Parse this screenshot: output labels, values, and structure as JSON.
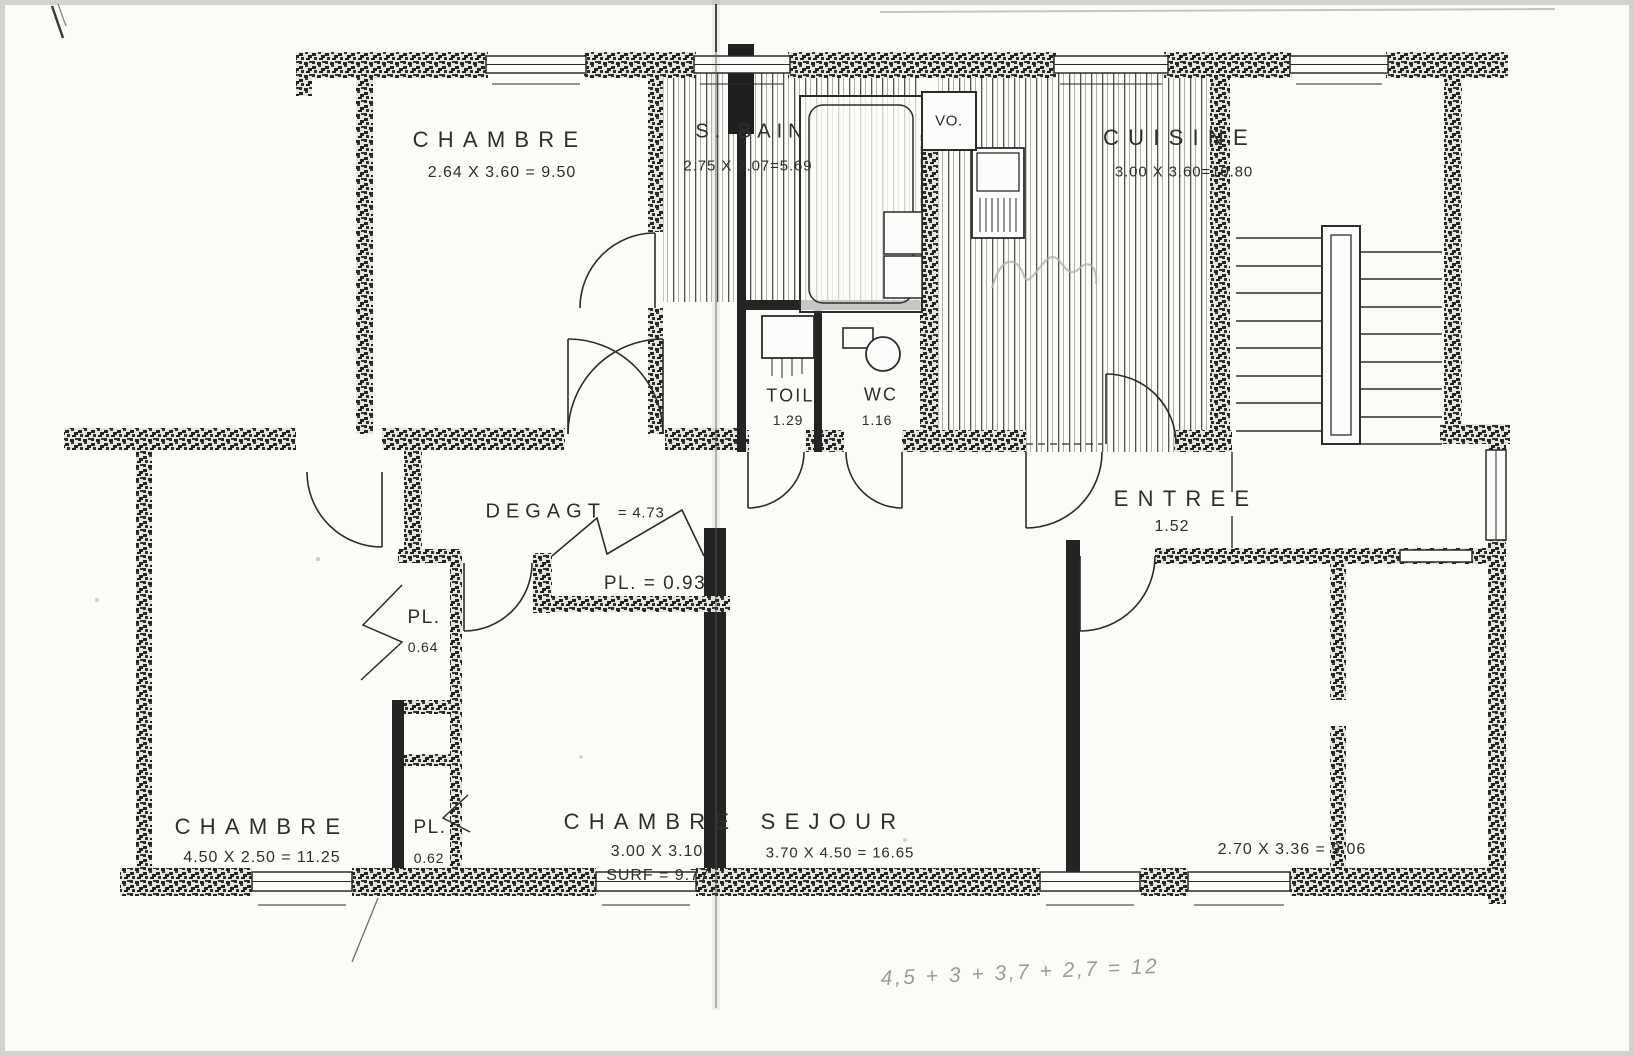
{
  "colors": {
    "ink": "#2b2b2b",
    "paper": "#fcfbf7",
    "pencil": "#9d9c98"
  },
  "rooms": {
    "chambre_top": {
      "label": "CHAMBRE",
      "dims": "2.64 X 3.60 = 9.50"
    },
    "salle_de_bain": {
      "label": "S. BAIN",
      "dims": "2.75 X 2.07=5.69"
    },
    "vide_ordures": {
      "label": "VO."
    },
    "cuisine": {
      "label": "CUISINE",
      "dims": "3.00 X 3.60=10.80"
    },
    "toilette": {
      "label": "TOIL.",
      "dims": "1.29"
    },
    "wc": {
      "label": "WC",
      "dims": "1.16"
    },
    "entree": {
      "label": "ENTREE",
      "dims": "1.52"
    },
    "degagement": {
      "label": "DEGAGT",
      "dims": "= 4.73"
    },
    "placard_hall": {
      "label": "PL. = 0.93"
    },
    "placard_upper": {
      "label": "PL.",
      "dims": "0.64"
    },
    "placard_lower": {
      "label": "PL.",
      "dims": "0.62"
    },
    "chambre_left": {
      "label": "CHAMBRE",
      "dims": "4.50 X 2.50 = 11.25"
    },
    "chambre_mid": {
      "label": "CHAMBRE",
      "dims": "3.00 X 3.10",
      "surface": "SURF = 9.77"
    },
    "sejour": {
      "label": "SEJOUR",
      "dims": "3.70 X 4.50 = 16.65"
    },
    "room_right": {
      "dims": "2.70 X 3.36 = 9.06"
    }
  },
  "annotations": {
    "pencil_note": "4,5 + 3 + 3,7 + 2,7 = 12"
  }
}
